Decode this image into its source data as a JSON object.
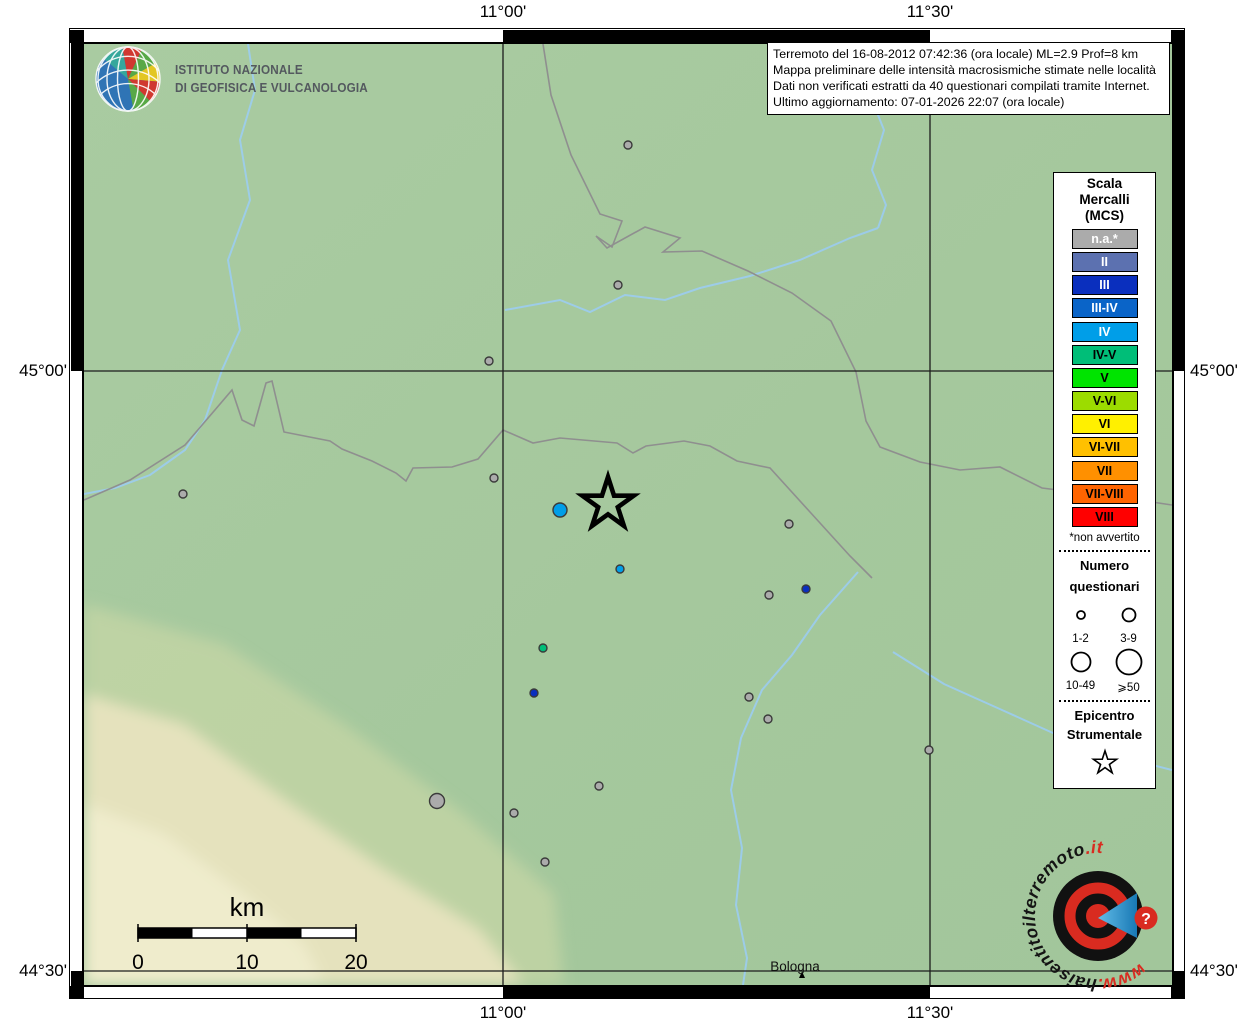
{
  "branding": {
    "institute_line1": "ISTITUTO NAZIONALE",
    "institute_line2": "DI GEOFISICA E VULCANOLOGIA"
  },
  "info_box": {
    "line1": "Terremoto del 16-08-2012 07:42:36 (ora locale) ML=2.9 Prof=8 km",
    "line2": "Mappa preliminare delle intensità macrosismiche stimate nelle località",
    "line3": "Dati non verificati estratti da 40 questionari compilati tramite Internet.",
    "line4": "Ultimo aggiornamento: 07-01-2026 22:07 (ora locale)"
  },
  "axis": {
    "lon_west": "11°00'",
    "lon_east": "11°30'",
    "lat_north": "45°00'",
    "lat_south": "44°30'"
  },
  "legend": {
    "title_lines": [
      "Scala",
      "Mercalli",
      "(MCS)"
    ],
    "scale": [
      {
        "label": "n.a.*",
        "color": "#ababab",
        "text_color": "#ffffff"
      },
      {
        "label": "II",
        "color": "#5c71b0",
        "text_color": "#ffffff"
      },
      {
        "label": "III",
        "color": "#0a2fbe",
        "text_color": "#ffffff"
      },
      {
        "label": "III-IV",
        "color": "#0a64c8",
        "text_color": "#ffffff"
      },
      {
        "label": "IV",
        "color": "#009ee8",
        "text_color": "#ffffff"
      },
      {
        "label": "IV-V",
        "color": "#00be78",
        "text_color": "#000000"
      },
      {
        "label": "V",
        "color": "#00e400",
        "text_color": "#000000"
      },
      {
        "label": "V-VI",
        "color": "#9cdc00",
        "text_color": "#000000"
      },
      {
        "label": "VI",
        "color": "#fff000",
        "text_color": "#000000"
      },
      {
        "label": "VI-VII",
        "color": "#ffc000",
        "text_color": "#000000"
      },
      {
        "label": "VII",
        "color": "#ff9000",
        "text_color": "#000000"
      },
      {
        "label": "VII-VIII",
        "color": "#ff6400",
        "text_color": "#000000"
      },
      {
        "label": "VIII",
        "color": "#ff0000",
        "text_color": "#000000"
      }
    ],
    "footnote": "*non avvertito",
    "questionnaires": {
      "title_lines": [
        "Numero",
        "questionari"
      ],
      "sizes": [
        {
          "label": "1-2",
          "radius": 4
        },
        {
          "label": "3-9",
          "radius": 6.5
        },
        {
          "label": "10-49",
          "radius": 9.5
        },
        {
          "label": "⩾50",
          "radius": 12.5
        }
      ]
    },
    "epicenter_title_lines": [
      "Epicentro",
      "Strumentale"
    ]
  },
  "scale_bar": {
    "title": "km",
    "ticks": [
      "0",
      "10",
      "20"
    ]
  },
  "map": {
    "city_label": "Bologna",
    "epicenter": {
      "x": 524,
      "y": 460
    },
    "points": [
      {
        "x": 544,
        "y": 101,
        "r": 4,
        "intensity": "n.a.*"
      },
      {
        "x": 534,
        "y": 241,
        "r": 4,
        "intensity": "n.a.*"
      },
      {
        "x": 405,
        "y": 317,
        "r": 4,
        "intensity": "n.a.*"
      },
      {
        "x": 99,
        "y": 450,
        "r": 4,
        "intensity": "n.a.*"
      },
      {
        "x": 410,
        "y": 434,
        "r": 4,
        "intensity": "n.a.*"
      },
      {
        "x": 476,
        "y": 466,
        "r": 7,
        "intensity": "IV"
      },
      {
        "x": 536,
        "y": 525,
        "r": 4,
        "intensity": "IV"
      },
      {
        "x": 705,
        "y": 480,
        "r": 4,
        "intensity": "n.a.*"
      },
      {
        "x": 722,
        "y": 545,
        "r": 4,
        "intensity": "III"
      },
      {
        "x": 685,
        "y": 551,
        "r": 4,
        "intensity": "n.a.*"
      },
      {
        "x": 459,
        "y": 604,
        "r": 4,
        "intensity": "IV-V"
      },
      {
        "x": 450,
        "y": 649,
        "r": 4,
        "intensity": "III"
      },
      {
        "x": 665,
        "y": 653,
        "r": 4,
        "intensity": "n.a.*"
      },
      {
        "x": 684,
        "y": 675,
        "r": 4,
        "intensity": "n.a.*"
      },
      {
        "x": 845,
        "y": 706,
        "r": 4,
        "intensity": "n.a.*"
      },
      {
        "x": 515,
        "y": 742,
        "r": 4,
        "intensity": "n.a.*"
      },
      {
        "x": 353,
        "y": 757,
        "r": 7.5,
        "intensity": "n.a.*"
      },
      {
        "x": 430,
        "y": 769,
        "r": 4,
        "intensity": "n.a.*"
      },
      {
        "x": 461,
        "y": 818,
        "r": 4,
        "intensity": "n.a.*"
      }
    ]
  },
  "watermark": {
    "prefix": "www.",
    "middle": "haisentitoilterremoto",
    "suffix": ".it",
    "question_mark": "?"
  }
}
